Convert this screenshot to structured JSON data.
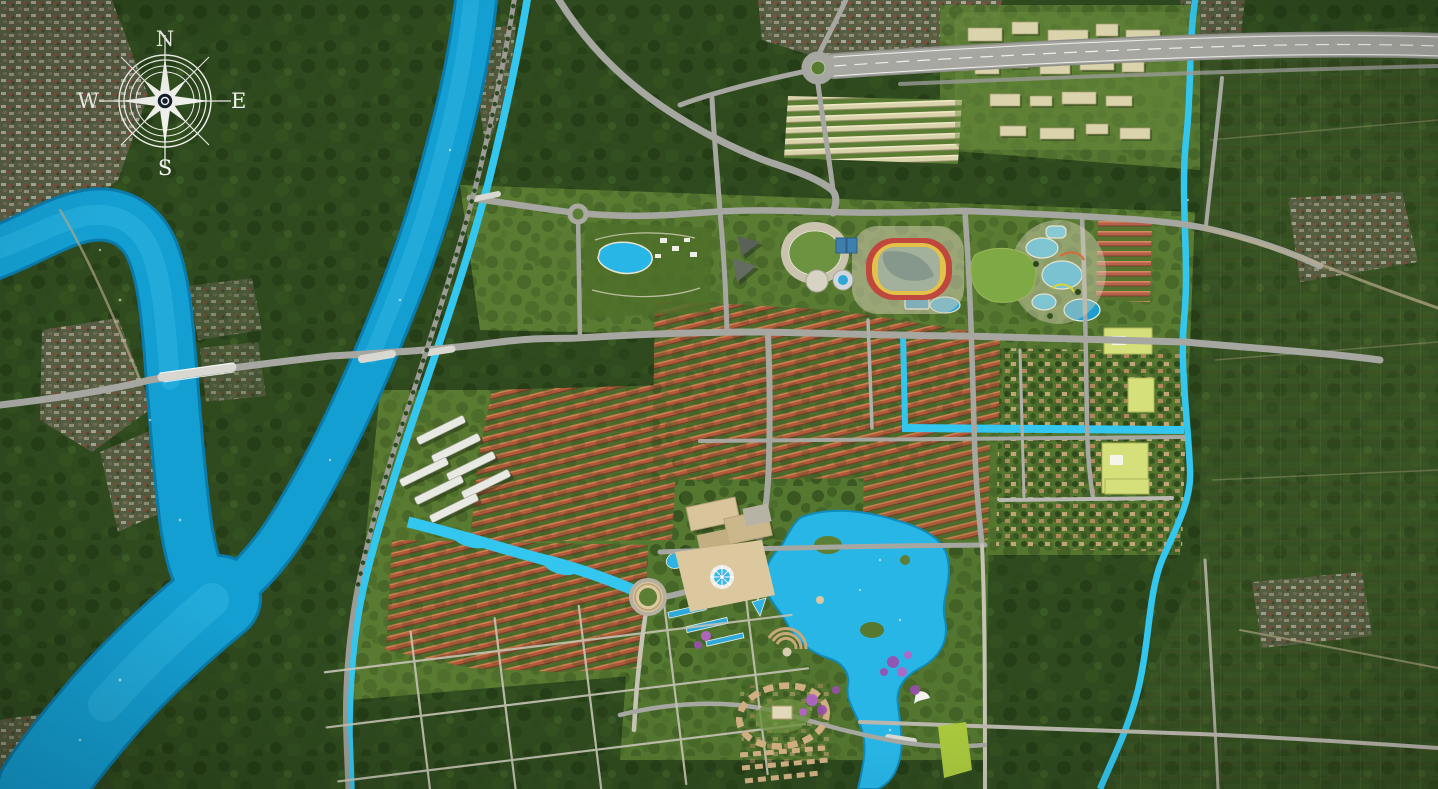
{
  "compass": {
    "north": "N",
    "east": "E",
    "south": "S",
    "west": "W"
  },
  "palette": {
    "water": "#149fd2",
    "water_dark": "#0a7cac",
    "water_bright": "#33c6ef",
    "lake": "#28b6e7",
    "forest": "#2f4a1f",
    "lawn": "#5d8034",
    "road": "#a7a7a1",
    "road_minor": "#c6c3b4",
    "roof_orange": "#b0593a",
    "roof_cream": "#dbd3ab",
    "building_white": "#e9e9e3",
    "stadium_ring": "#c0473e",
    "stadium_roof": "#a2b09c",
    "school_yellow": "#d6e07b",
    "plaza_tan": "#dbc89e",
    "flower_purple": "#9a4fae",
    "field_lime": "#a9c83d",
    "compass_white": "#f5f5f0"
  },
  "features": {
    "river": "main-river",
    "canal": "boundary-canal",
    "lake": "central-lake",
    "stadium": "stadium",
    "water_park": "water-park",
    "plaza": "central-plaza-fountain",
    "compass": "compass-rose"
  }
}
